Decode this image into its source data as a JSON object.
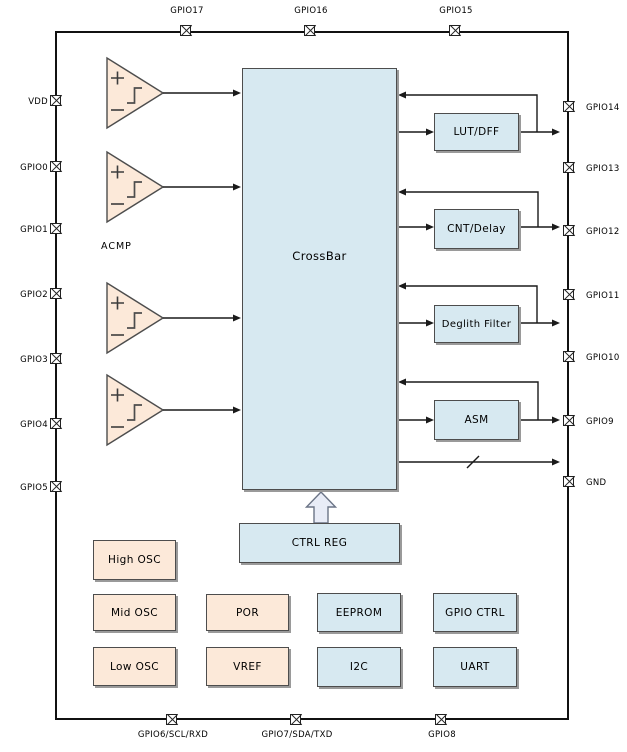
{
  "diagram": {
    "type": "chip-block-diagram",
    "crossbar_label": "CrossBar",
    "acmp_label": "ACMP",
    "ctrl_reg_label": "CTRL REG"
  },
  "pins": {
    "top": [
      "GPIO17",
      "GPIO16",
      "GPIO15"
    ],
    "left": [
      "VDD",
      "GPIO0",
      "GPIO1",
      "GPIO2",
      "GPIO3",
      "GPIO4",
      "GPIO5"
    ],
    "right": [
      "GPIO14",
      "GPIO13",
      "GPIO12",
      "GPIO11",
      "GPIO10",
      "GPIO9",
      "GND"
    ],
    "bottom": [
      "GPIO6/SCL/RXD",
      "GPIO7/SDA/TXD",
      "GPIO8"
    ]
  },
  "blocks": {
    "function": [
      "LUT/DFF",
      "CNT/Delay",
      "Deglith Filter",
      "ASM"
    ],
    "oscillators": [
      "High OSC",
      "Mid OSC",
      "Low OSC"
    ],
    "analog": [
      "POR",
      "VREF"
    ],
    "peripherals": [
      "EEPROM",
      "GPIO CTRL",
      "I2C",
      "UART"
    ]
  },
  "colors": {
    "block_blue": "#d7e9f1",
    "block_peach": "#fce9d9",
    "arrow_fill": "#e8ecf7",
    "block_border": "#4d4d4d",
    "wire": "#1a1a1a",
    "background": "#ffffff"
  }
}
